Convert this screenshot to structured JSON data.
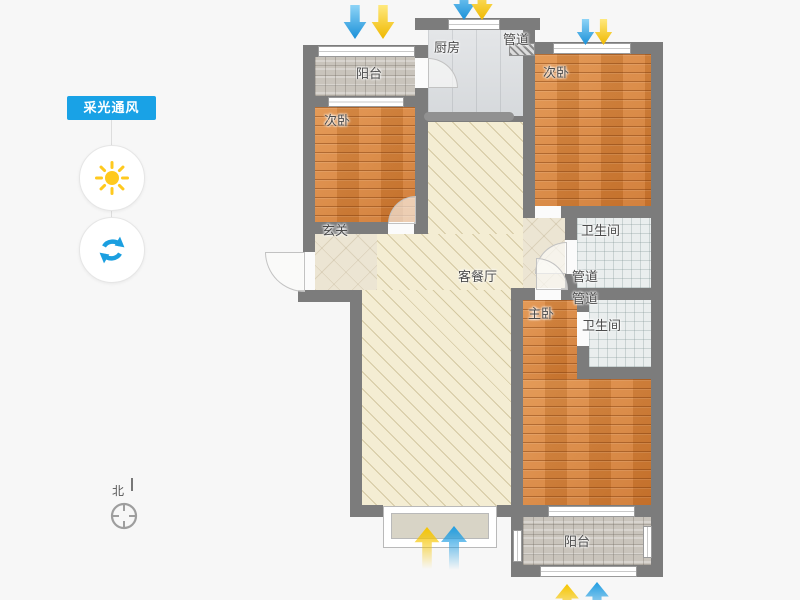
{
  "panel": {
    "title": "采光通风"
  },
  "compass": {
    "north": "北"
  },
  "rooms": {
    "balcony_top": "阳台",
    "bedroom_left": "次卧",
    "kitchen": "厨房",
    "duct_top": "管道",
    "bedroom_right": "次卧",
    "bathroom_top": "卫生间",
    "duct_mid_1": "管道",
    "duct_mid_2": "管道",
    "bathroom_bottom": "卫生间",
    "master_bedroom": "主卧",
    "living_dining": "客餐厅",
    "entry": "玄关",
    "balcony_bottom": "阳台"
  },
  "colors": {
    "accent_blue": "#19a2e6",
    "wall": "#7c7c7c",
    "wood_floor": "#d9853e",
    "living_floor": "#f4edd3",
    "arrow_blue": "#2aa7e8",
    "arrow_yellow": "#f6c500",
    "sun_yellow": "#ffc91e"
  }
}
